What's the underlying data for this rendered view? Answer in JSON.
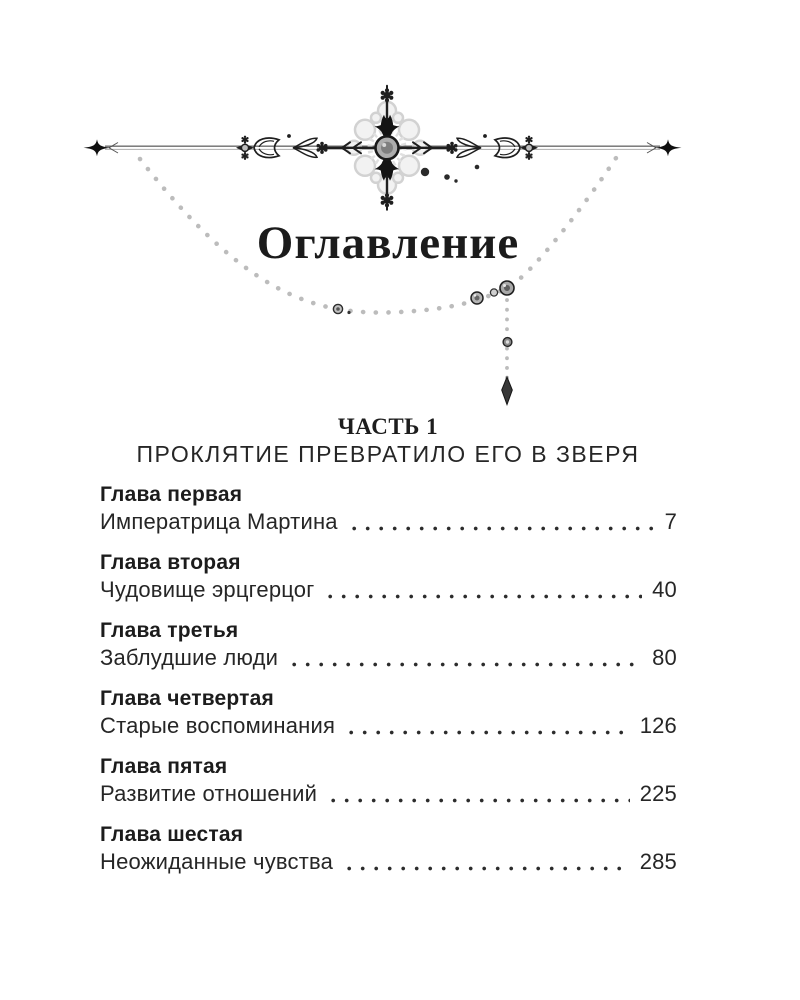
{
  "document": {
    "title": "Оглавление",
    "part": {
      "label": "ЧАСТЬ 1",
      "subtitle": "ПРОКЛЯТИЕ ПРЕВРАТИЛО ЕГО В ЗВЕРЯ"
    },
    "chapters": [
      {
        "heading": "Глава первая",
        "title": "Императрица Мартина",
        "page": "7"
      },
      {
        "heading": "Глава вторая",
        "title": "Чудовище эрцгерцог",
        "page": "40"
      },
      {
        "heading": "Глава третья",
        "title": "Заблудшие люди",
        "page": "80"
      },
      {
        "heading": "Глава четвертая",
        "title": "Старые воспоминания",
        "page": "126"
      },
      {
        "heading": "Глава пятая",
        "title": "Развитие отношений",
        "page": "225"
      },
      {
        "heading": "Глава шестая",
        "title": "Неожиданные чувства",
        "page": "285"
      }
    ]
  },
  "ornament": {
    "kind": "chapter-head decoration",
    "elements": [
      "sparkle-stars",
      "rule-line",
      "floral-cross",
      "leaf-flourishes",
      "bead-garland",
      "jewel-pendant",
      "ink-specks"
    ]
  },
  "colors": {
    "ink": "#1f1f1f",
    "garland_dots": "#bcbcbc",
    "lace_fill": "#f2f2f2",
    "lace_edge": "#d2d2d2",
    "paper": "#ffffff"
  }
}
